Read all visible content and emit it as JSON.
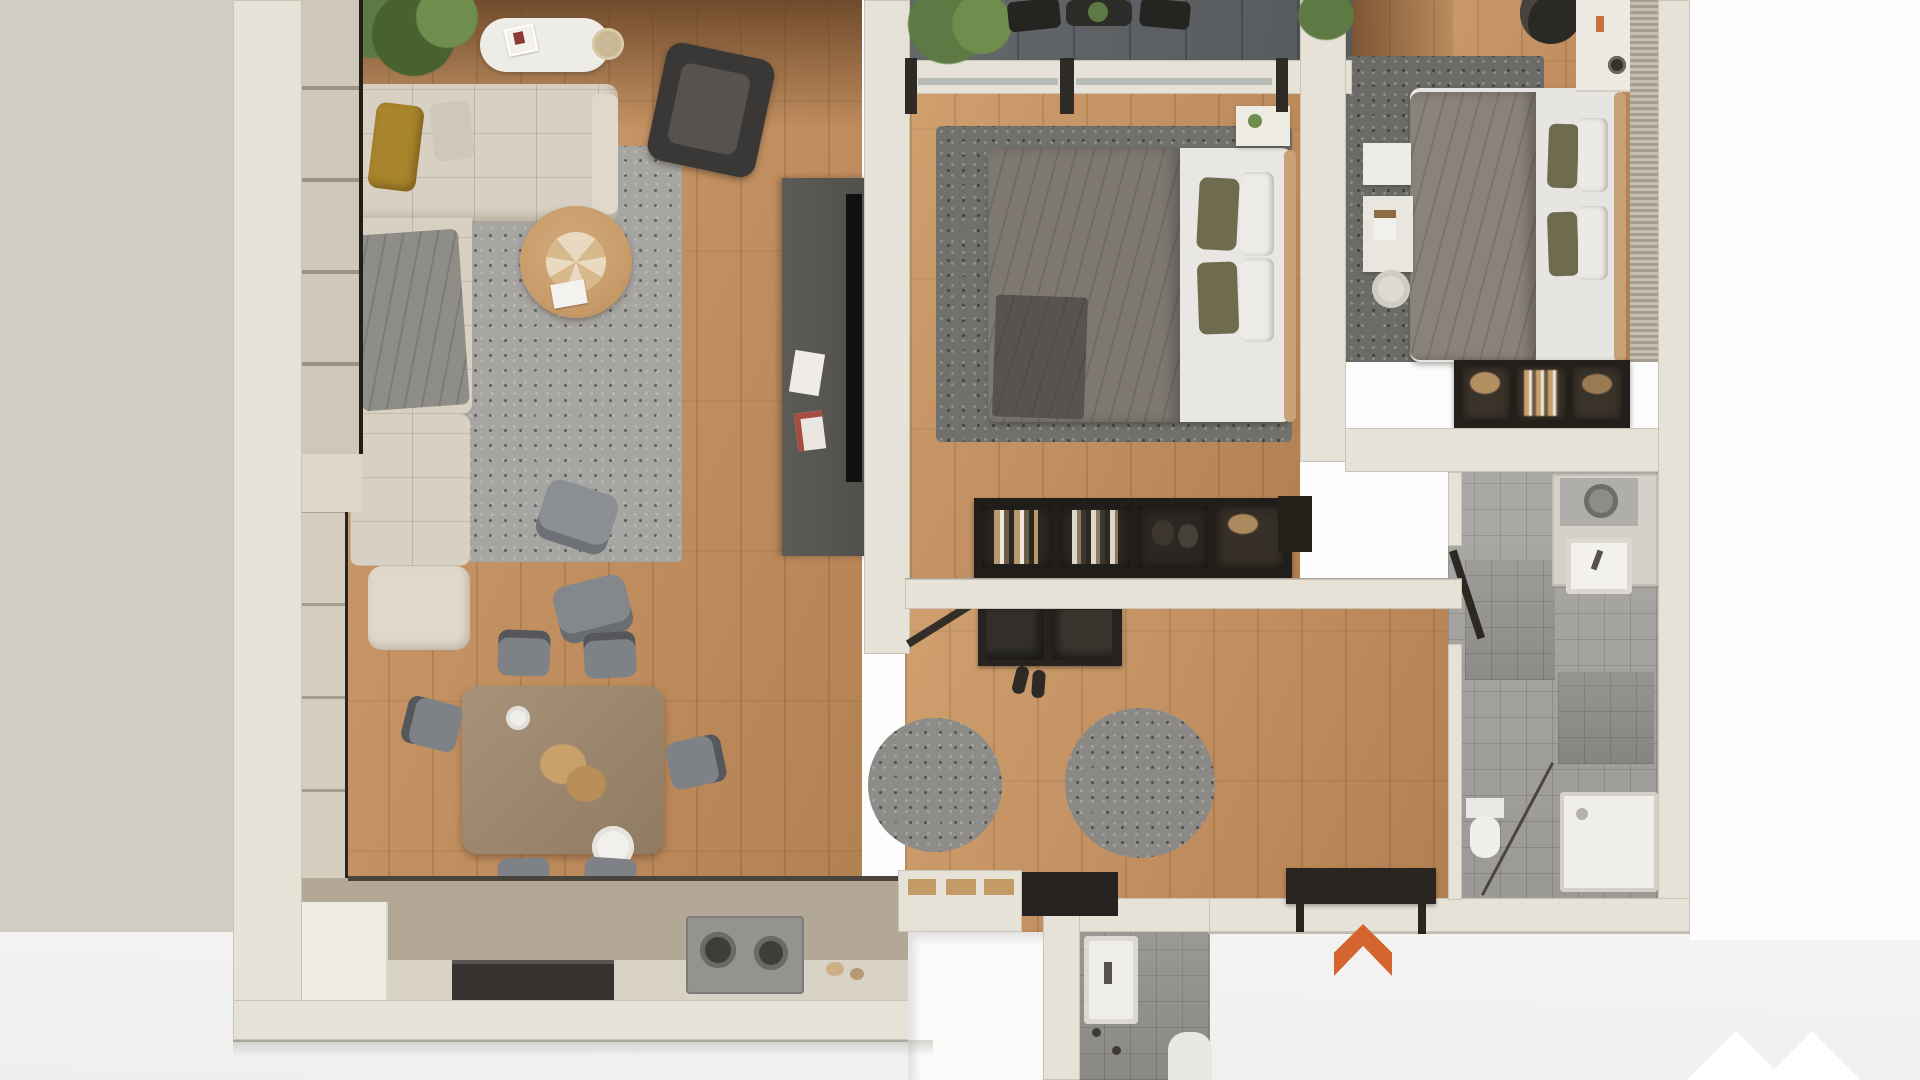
{
  "scene": {
    "type": "apartment-floor-plan-3d-top-view",
    "visible_text": "none",
    "rooms": [
      {
        "name": "living-room",
        "furniture": [
          "corner-sofa",
          "mustard-pillow",
          "gray-blanket",
          "ottoman",
          "coffee-table",
          "leather-armchair",
          "tv-console",
          "tv",
          "area-rug",
          "potted-plant",
          "console-table",
          "sideboard"
        ]
      },
      {
        "name": "dining-area",
        "furniture": [
          "dining-table",
          "dining-chairs-x6",
          "lounge-chairs-x2",
          "vase-dried-flowers",
          "tableware"
        ]
      },
      {
        "name": "kitchen",
        "furniture": [
          "counter",
          "tall-cabinets",
          "white-cabinet",
          "oven-dark",
          "cooktop-two-burners"
        ]
      },
      {
        "name": "balcony",
        "furniture": [
          "potted-plants",
          "bistro-table",
          "outdoor-chairs",
          "sliding-door"
        ]
      },
      {
        "name": "bedroom-1",
        "furniture": [
          "double-bed",
          "gray-duvet",
          "olive-pillows",
          "white-pillows",
          "headboard-wood",
          "nightstand",
          "area-rug-dark",
          "wardrobe-row",
          "dark-throw"
        ]
      },
      {
        "name": "bedroom-2",
        "furniture": [
          "double-bed",
          "taupe-duvet",
          "olive-pillows",
          "white-pillows",
          "headboard-wood",
          "nightstands",
          "round-stool",
          "black-round-chair",
          "white-cabinet",
          "striped-wardrobe",
          "lit-closet-row"
        ]
      },
      {
        "name": "bathroom",
        "furniture": [
          "boiler",
          "counter-sink",
          "patterned-tiles",
          "toilet",
          "shower-tray",
          "glass-partition",
          "door-leaf"
        ]
      },
      {
        "name": "wc",
        "furniture": [
          "sink",
          "toilet",
          "tiled-floor"
        ]
      },
      {
        "name": "hallway",
        "furniture": [
          "closet-row",
          "hall-closets",
          "round-rug-small",
          "round-rug-large",
          "slippers",
          "shoe-bench",
          "dark-cabinet"
        ]
      }
    ],
    "markers": {
      "entrance_arrow": {
        "icon": "chevron-up-icon",
        "meaning": "entrance",
        "color": "#d4652f"
      },
      "nav_hint": {
        "icon": "double-chevron-icon",
        "color": "#ffffff",
        "position": "bottom-right"
      }
    }
  },
  "theme": {
    "bg_white": "#fdfdfd",
    "bg_beige": "#d3cec5",
    "bg_light": "#eff0ee",
    "cutout_white": "#fbfbfa",
    "wall": "#e7e2d7",
    "wall_edge": "#c4bfb2",
    "floor_oak": "#bf8c5d",
    "floor_oak_light": "#d0a06f",
    "floor_walnut": "#7c583a",
    "balcony_tile": "#565a5d",
    "rug_gray": "#a7a5a1",
    "rug_dark": "#70706c",
    "rug_round": "#8d8c88",
    "sofa_beige": "#d8d1c3",
    "sofa_light": "#e0d9cb",
    "pillow_mustard": "#a8842c",
    "blanket_gray": "#8f8d88",
    "duvet_gray": "#7e7871",
    "duvet_taupe": "#8a837a",
    "linen_white": "#e9e7e3",
    "pillow_olive": "#6f6b4f",
    "wood_head": "#c8a176",
    "closet_dark": "#201d1a",
    "closet_inner": "#2b2723",
    "clothes_tan": "#c9a06b",
    "counter_taupe": "#b3a896",
    "counter_light": "#d9d3c6",
    "appliance_dark": "#35322f",
    "tile_bath": "#a5a39f",
    "tile_wc": "#93918d",
    "white_item": "#eeece7",
    "furniture_black": "#3a3836",
    "chair_gray": "#7e8287",
    "table_wood": "#9f8a70",
    "plant_green": "#5d7a44",
    "plant_green_dark": "#47612f",
    "accent_orange": "#d4652f",
    "glass_line": "#a9b0ad"
  }
}
